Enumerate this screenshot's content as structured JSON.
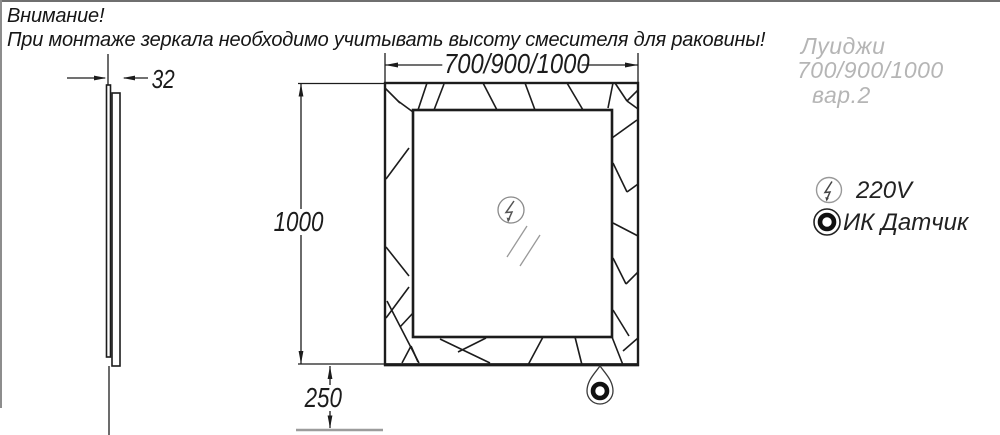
{
  "notice": {
    "line1": "Внимание!",
    "line2": "При монтаже зеркала необходимо учитывать высоту смесителя для раковины!"
  },
  "front_view": {
    "width_dim": "700/900/1000",
    "height_dim": "1000",
    "bottom_offset_dim": "250"
  },
  "side_view": {
    "thickness_dim": "32"
  },
  "product": {
    "name": "Луиджи",
    "sizes": "700/900/1000",
    "variant": "вар.2"
  },
  "legend": {
    "power": {
      "icon": "lightning-circle-icon",
      "label": "220V"
    },
    "sensor": {
      "icon": "ir-sensor-icon",
      "label": "ИК Датчик"
    }
  },
  "colors": {
    "line": "#1c1c1c",
    "muted_line": "#9c9c9c",
    "ghost_text": "#b5b5b5"
  }
}
